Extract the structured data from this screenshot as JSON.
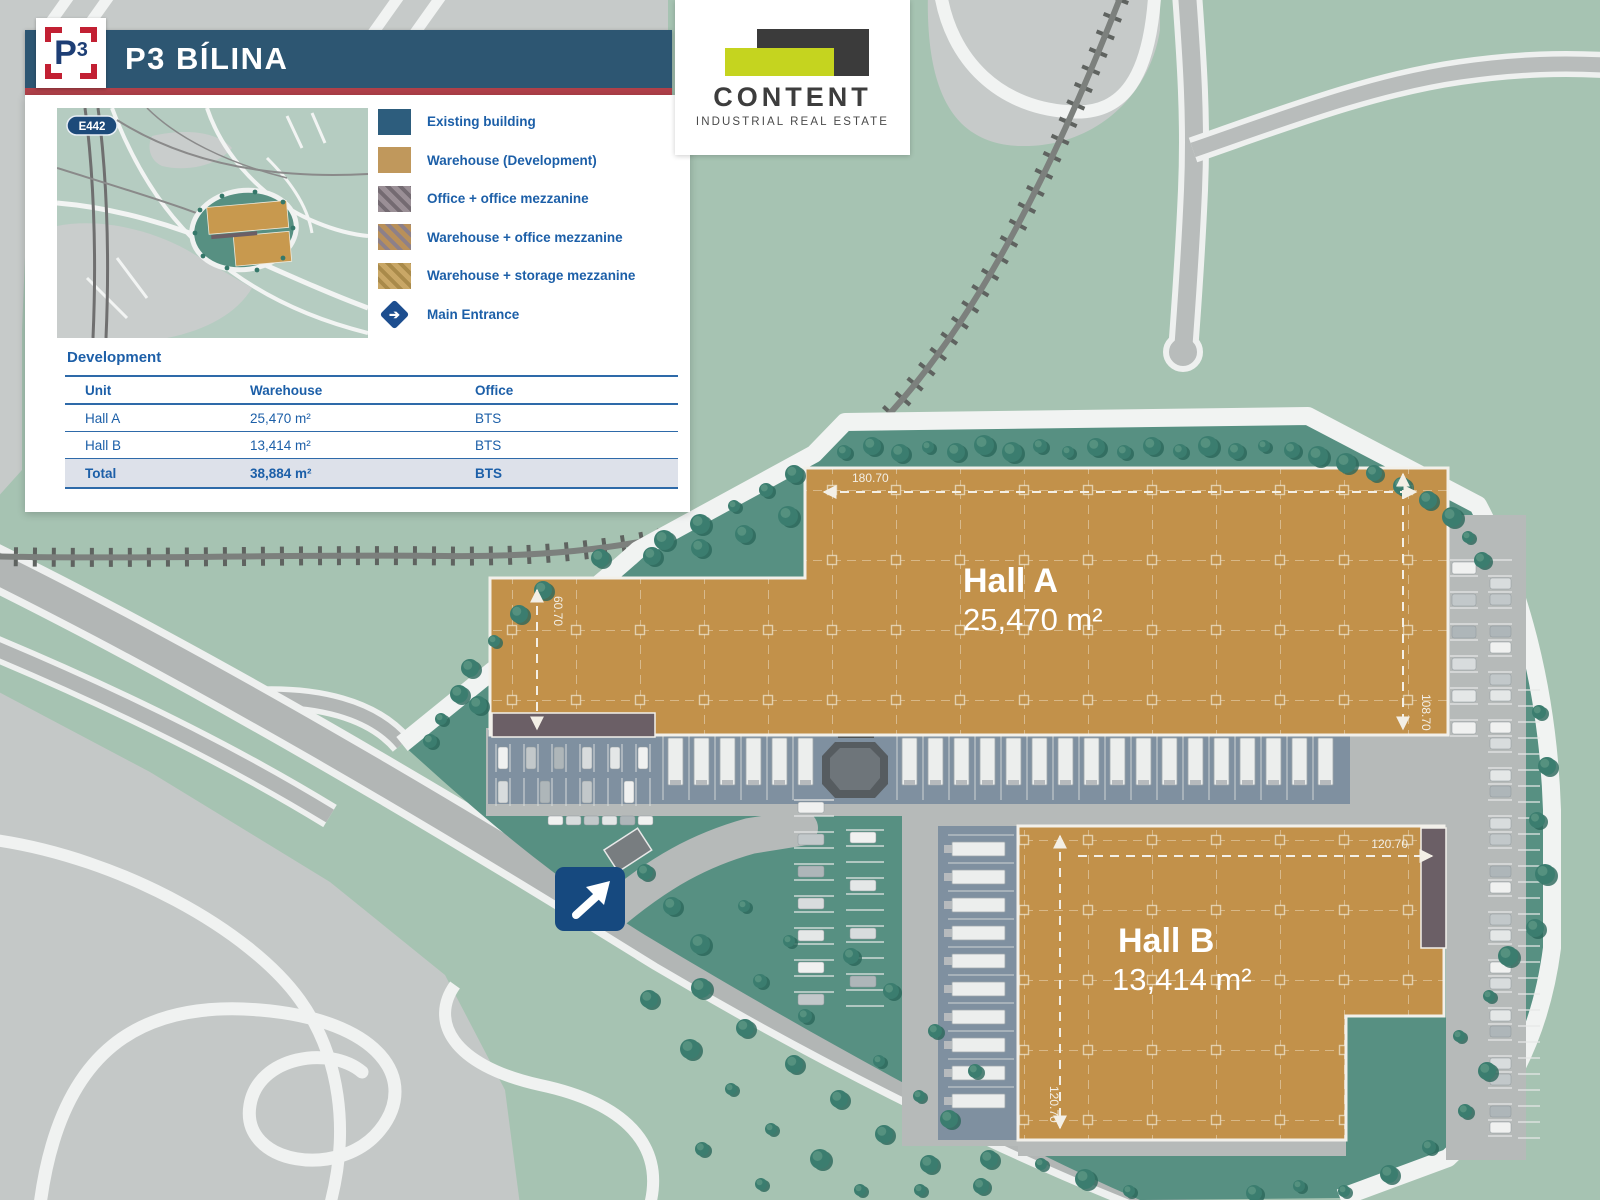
{
  "header": {
    "logo_p": "P",
    "logo_exp": "3",
    "title": "P3 BÍLINA"
  },
  "brand": {
    "name": "CONTENT",
    "tagline": "INDUSTRIAL REAL ESTATE"
  },
  "inset_map": {
    "route_badge": "E442"
  },
  "legend": {
    "items": [
      {
        "label": "Existing building"
      },
      {
        "label": "Warehouse (Development)"
      },
      {
        "label": "Office + office mezzanine"
      },
      {
        "label": "Warehouse + office mezzanine"
      },
      {
        "label": "Warehouse + storage mezzanine"
      },
      {
        "label": "Main Entrance"
      }
    ]
  },
  "development": {
    "title": "Development",
    "columns": {
      "unit": "Unit",
      "warehouse": "Warehouse",
      "office": "Office"
    },
    "rows": [
      {
        "unit": "Hall A",
        "warehouse": "25,470 m²",
        "office": "BTS"
      },
      {
        "unit": "Hall B",
        "warehouse": "13,414 m²",
        "office": "BTS"
      }
    ],
    "total": {
      "unit": "Total",
      "warehouse": "38,884 m²",
      "office": "BTS"
    }
  },
  "site_plan": {
    "hall_a": {
      "name": "Hall A",
      "area": "25,470 m²",
      "dim_top": "180.70",
      "dim_right": "108.70",
      "dim_left": "60.70"
    },
    "hall_b": {
      "name": "Hall B",
      "area": "13,414 m²",
      "dim_top": "120.70",
      "dim_left": "120.70"
    }
  },
  "colors": {
    "banner_blue": "#2d5672",
    "accent_red": "#b04049",
    "text_blue": "#1c5fa8",
    "existing_blue": "#2d5d7d",
    "warehouse_tan": "#c2914a",
    "brand_lime": "#c5d41f",
    "brand_dark": "#3b3b3b",
    "site_green": "#579082",
    "outer_green": "#a6c3b2",
    "entrance_blue": "#16497f"
  }
}
